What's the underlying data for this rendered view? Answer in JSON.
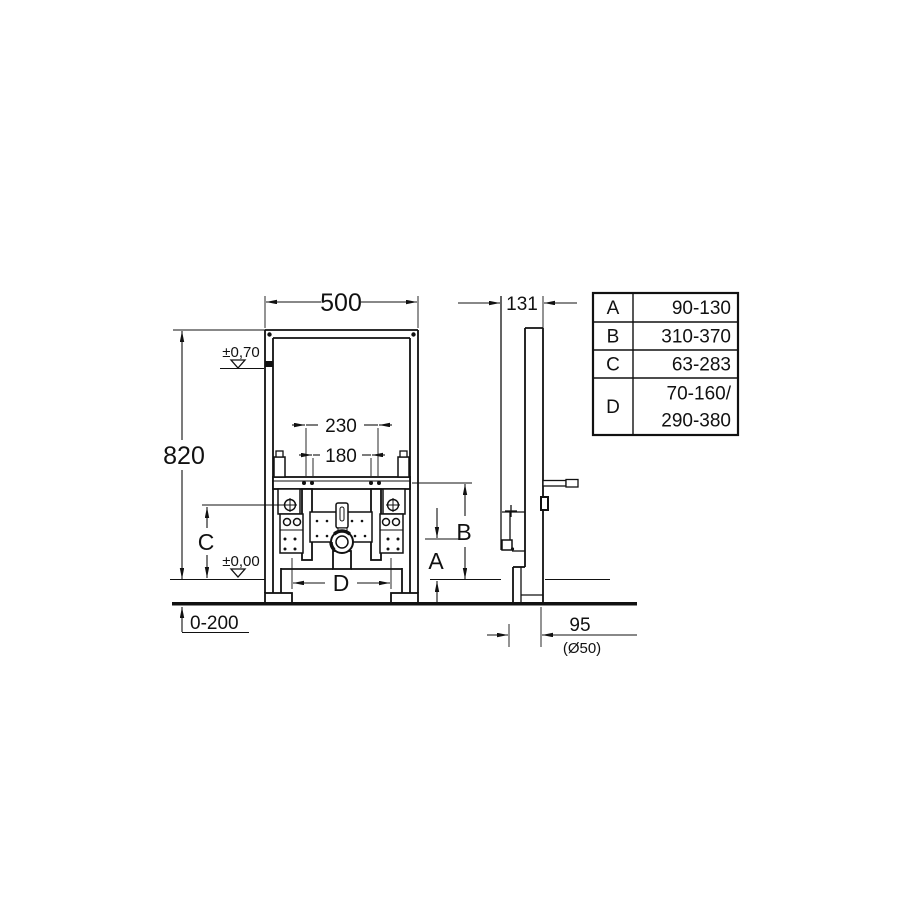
{
  "colors": {
    "ink": "#111111",
    "background": "#ffffff"
  },
  "front_view": {
    "width": "500",
    "height": "820",
    "level_top": "±0,70",
    "level_zero": "±0,00",
    "spacing_outer": "230",
    "spacing_inner": "180",
    "dim_a": "A",
    "dim_b": "B",
    "dim_c": "C",
    "dim_d": "D",
    "floor_range": "0-200"
  },
  "side_view": {
    "depth": "131",
    "outlet_offset": "95",
    "outlet_diameter": "(Ø50)"
  },
  "dimension_table": {
    "rows": [
      {
        "key": "A",
        "value": "90-130"
      },
      {
        "key": "B",
        "value": "310-370"
      },
      {
        "key": "C",
        "value": "63-283"
      },
      {
        "key": "D",
        "value": "70-160/",
        "value2": "290-380"
      }
    ]
  }
}
